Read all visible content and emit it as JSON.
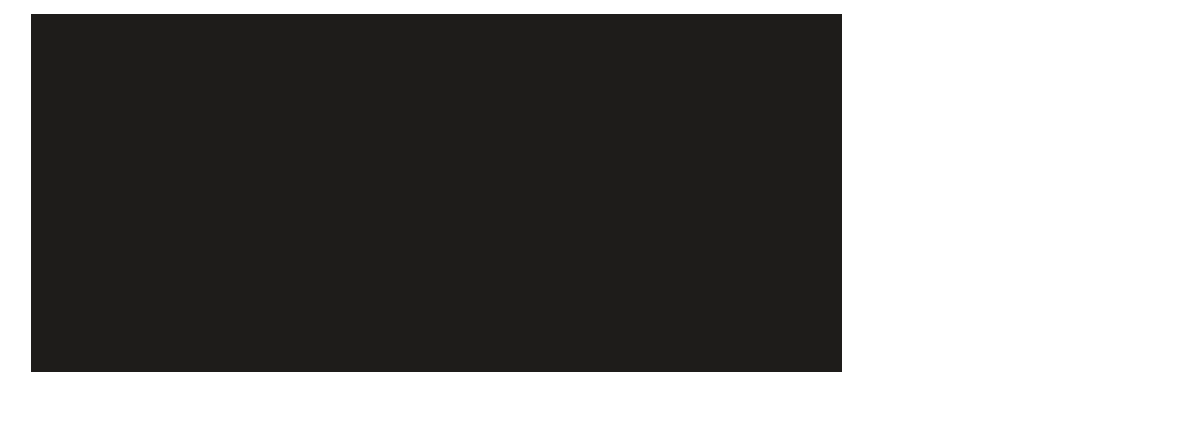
{
  "canvas": {
    "background_color": "#ffffff"
  },
  "display": {
    "background_color": "#1e1c1a"
  }
}
